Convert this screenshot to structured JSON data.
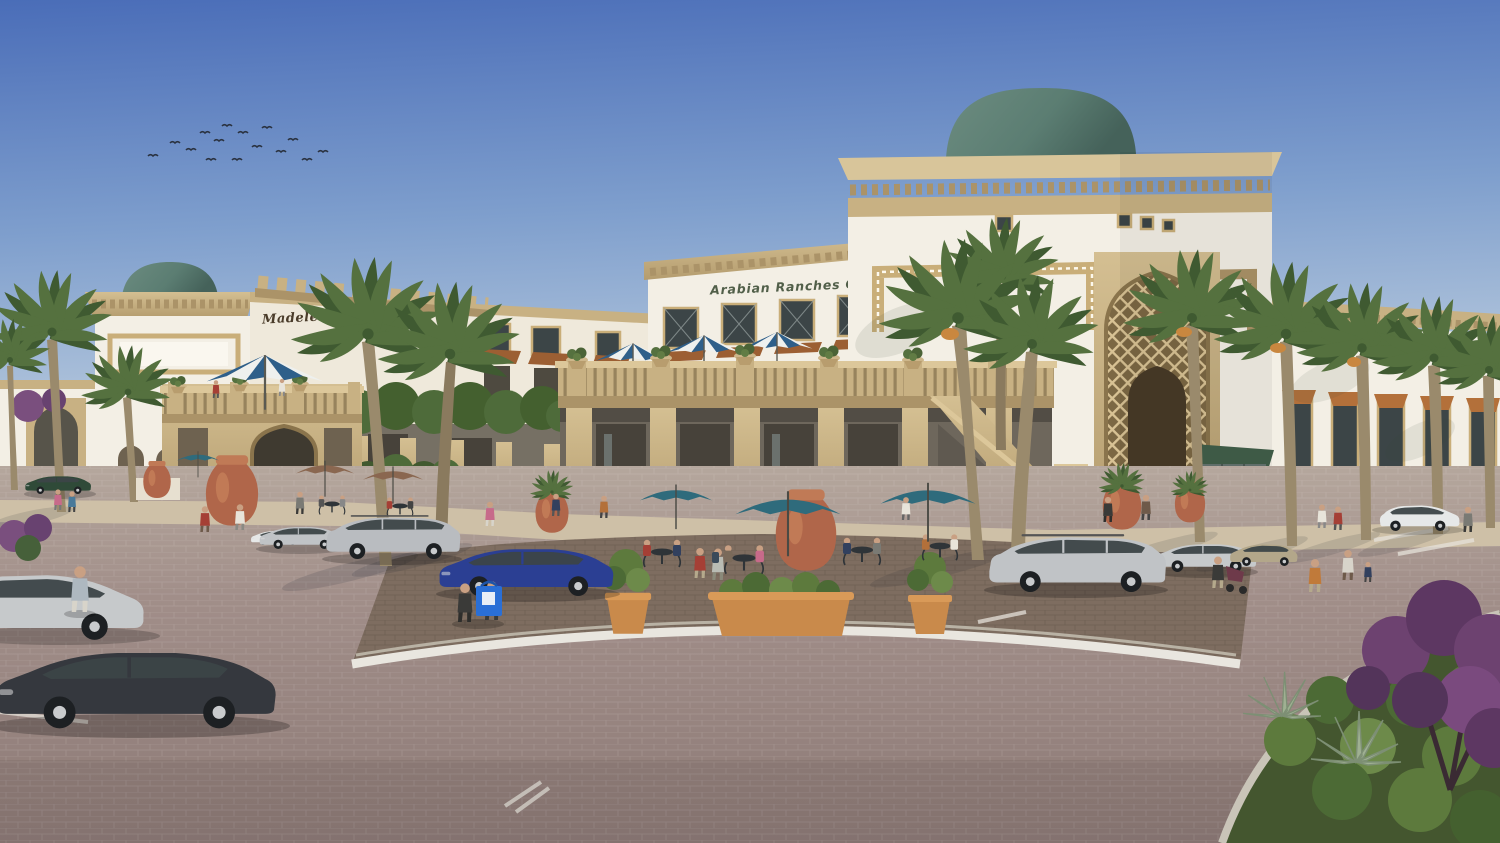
{
  "signs": {
    "left_building": "Madeleine",
    "center_building": "Arabian Ranches Café"
  },
  "colors": {
    "sky_top": "#4a6db8",
    "sky_mid": "#7f9fcd",
    "sky_horizon": "#d6e0ea",
    "wall_white": "#f3efe5",
    "wall_shade": "#e7e0d0",
    "sandstone": "#c8b183",
    "sandstone_dark": "#ab9368",
    "trim_tan": "#c9ae79",
    "dome_green": "#5b7d72",
    "window_dark": "#3c4547",
    "wood_brown": "#9c5f33",
    "paving_mauve": "#98847f",
    "paving_far": "#b5a79d",
    "sidewalk": "#cec0a7",
    "plaza_brown": "#7e6d60",
    "curb_white": "#e9e6df",
    "planter_orange": "#c98a4b",
    "terracotta": "#b0664a",
    "umbrella_teal": "#2f6b7c",
    "umbrella_taupe": "#8a6750",
    "stripe_blue": "#2e5f8a",
    "palm_green": "#55713f",
    "palm_dark": "#3f5a31",
    "trunk_tan": "#9a8a6c",
    "hedge_green": "#4e6b3a",
    "bougainvillea_purple": "#6d4270",
    "awning_green": "#3e5a46",
    "awning_orange": "#b3703a",
    "car_dark": "#35383e",
    "car_silver": "#c0c3c6",
    "car_blue": "#2b3f93",
    "car_green": "#2f4a38",
    "car_beige": "#b3a78a",
    "car_white": "#e6e8e8"
  }
}
